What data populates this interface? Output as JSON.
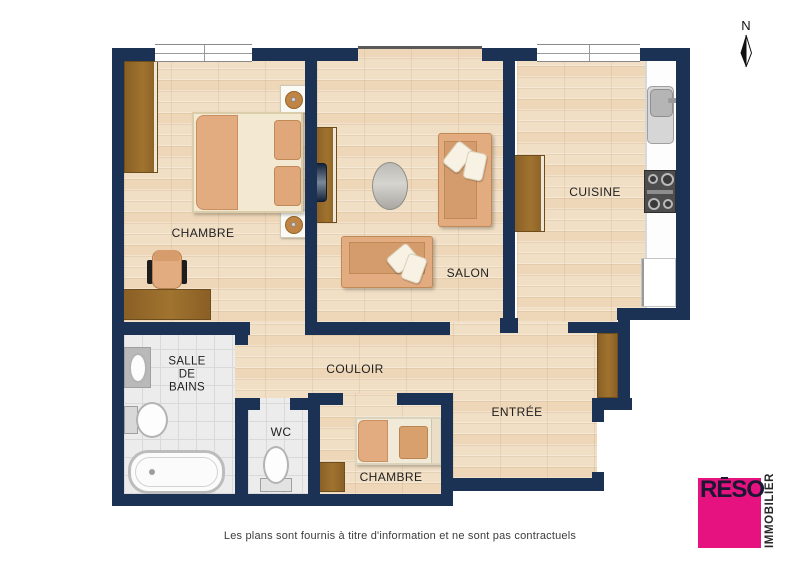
{
  "plan": {
    "rooms": {
      "chambre1": {
        "label": "CHAMBRE"
      },
      "salon": {
        "label": "SALON"
      },
      "cuisine": {
        "label": "CUISINE"
      },
      "salle_de_bains": {
        "lines": [
          "SALLE",
          "DE",
          "BAINS"
        ]
      },
      "couloir": {
        "label": "COULOIR"
      },
      "wc": {
        "label": "WC"
      },
      "chambre2": {
        "label": "CHAMBRE"
      },
      "entree": {
        "label": "ENTRÉE"
      }
    },
    "compass": {
      "north_label": "N"
    },
    "footer": {
      "disclaimer": "Les plans sont fournis à titre d'information et ne sont pas contractuels"
    },
    "logo": {
      "name": "RĒSO",
      "tagline": "IMMOBILIER",
      "accent_color": "#e5127f",
      "text_color": "#1c1733"
    },
    "colors": {
      "wall": "#1b3254",
      "wood_floor": "#f1dfc5",
      "tile_floor": "#ececec",
      "furniture_brown": "#96682c",
      "upholstery_tan": "#e3ab80"
    }
  }
}
